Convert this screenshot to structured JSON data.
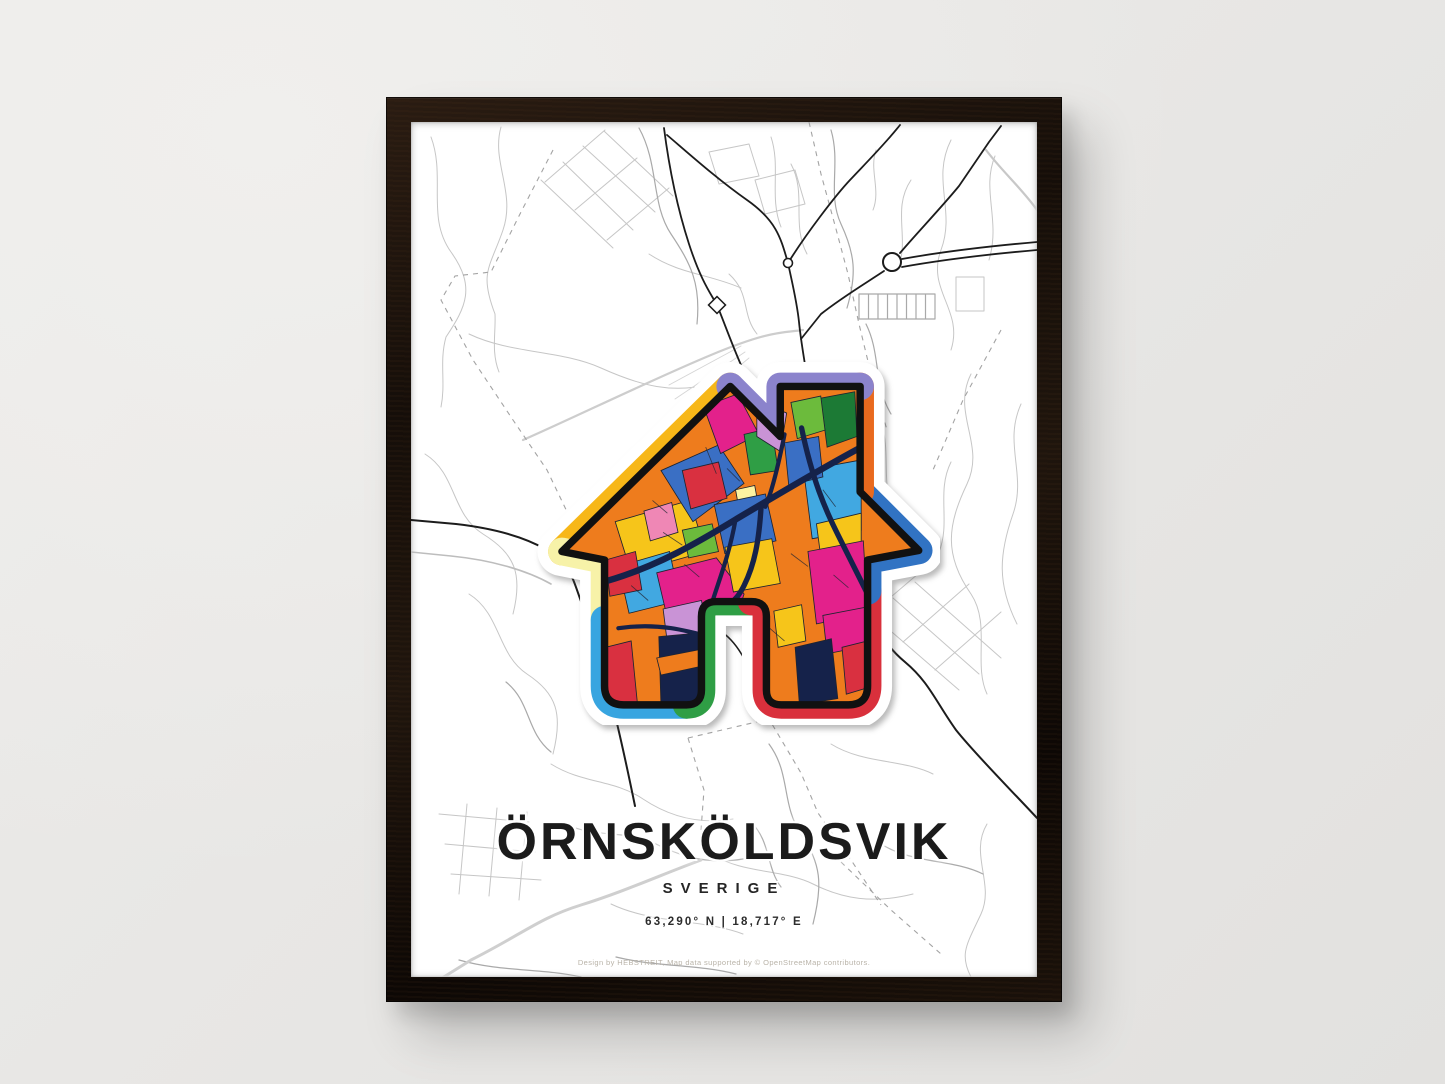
{
  "scene": {
    "description": "Framed city map art poster hanging on a light gray wall",
    "wall_color": "#e9e8e6",
    "frame_color": "#17100a"
  },
  "poster": {
    "title": "ÖRNSKÖLDSVIK",
    "subtitle": "SVERIGE",
    "coordinates": "63,290° N | 18,717° E",
    "credit": "Design by HEBSTREIT, Map data supported by © OpenStreetMap contributors.",
    "art": {
      "name": "house-map-art",
      "style": "colorful pop-art city map inside house silhouette with chimney and door cutout",
      "border_palette": [
        "#f7b718",
        "#8b83cc",
        "#e96a1e",
        "#3173c3",
        "#d9303c",
        "#2f9e45",
        "#38a5e0",
        "#f7f2a8"
      ],
      "mosaic_palette": [
        "#ee7c1d",
        "#e3218b",
        "#d93040",
        "#3a6fc4",
        "#41a8e1",
        "#f6c51a",
        "#fdf3a1",
        "#2f9e45",
        "#1c7a35",
        "#6cbb3c",
        "#c993d6",
        "#ef87b5",
        "#15224a"
      ],
      "inner_road_color": "#15224a",
      "outline_color": "#111111"
    },
    "map_colors": {
      "background": "#ffffff",
      "minor_street": "#c6c6c6",
      "medium_street": "#a9a9a9",
      "major_road": "#1c1c1c",
      "dashed_boundary": "#a3a3a3",
      "railway": "#cdcdcd"
    }
  }
}
